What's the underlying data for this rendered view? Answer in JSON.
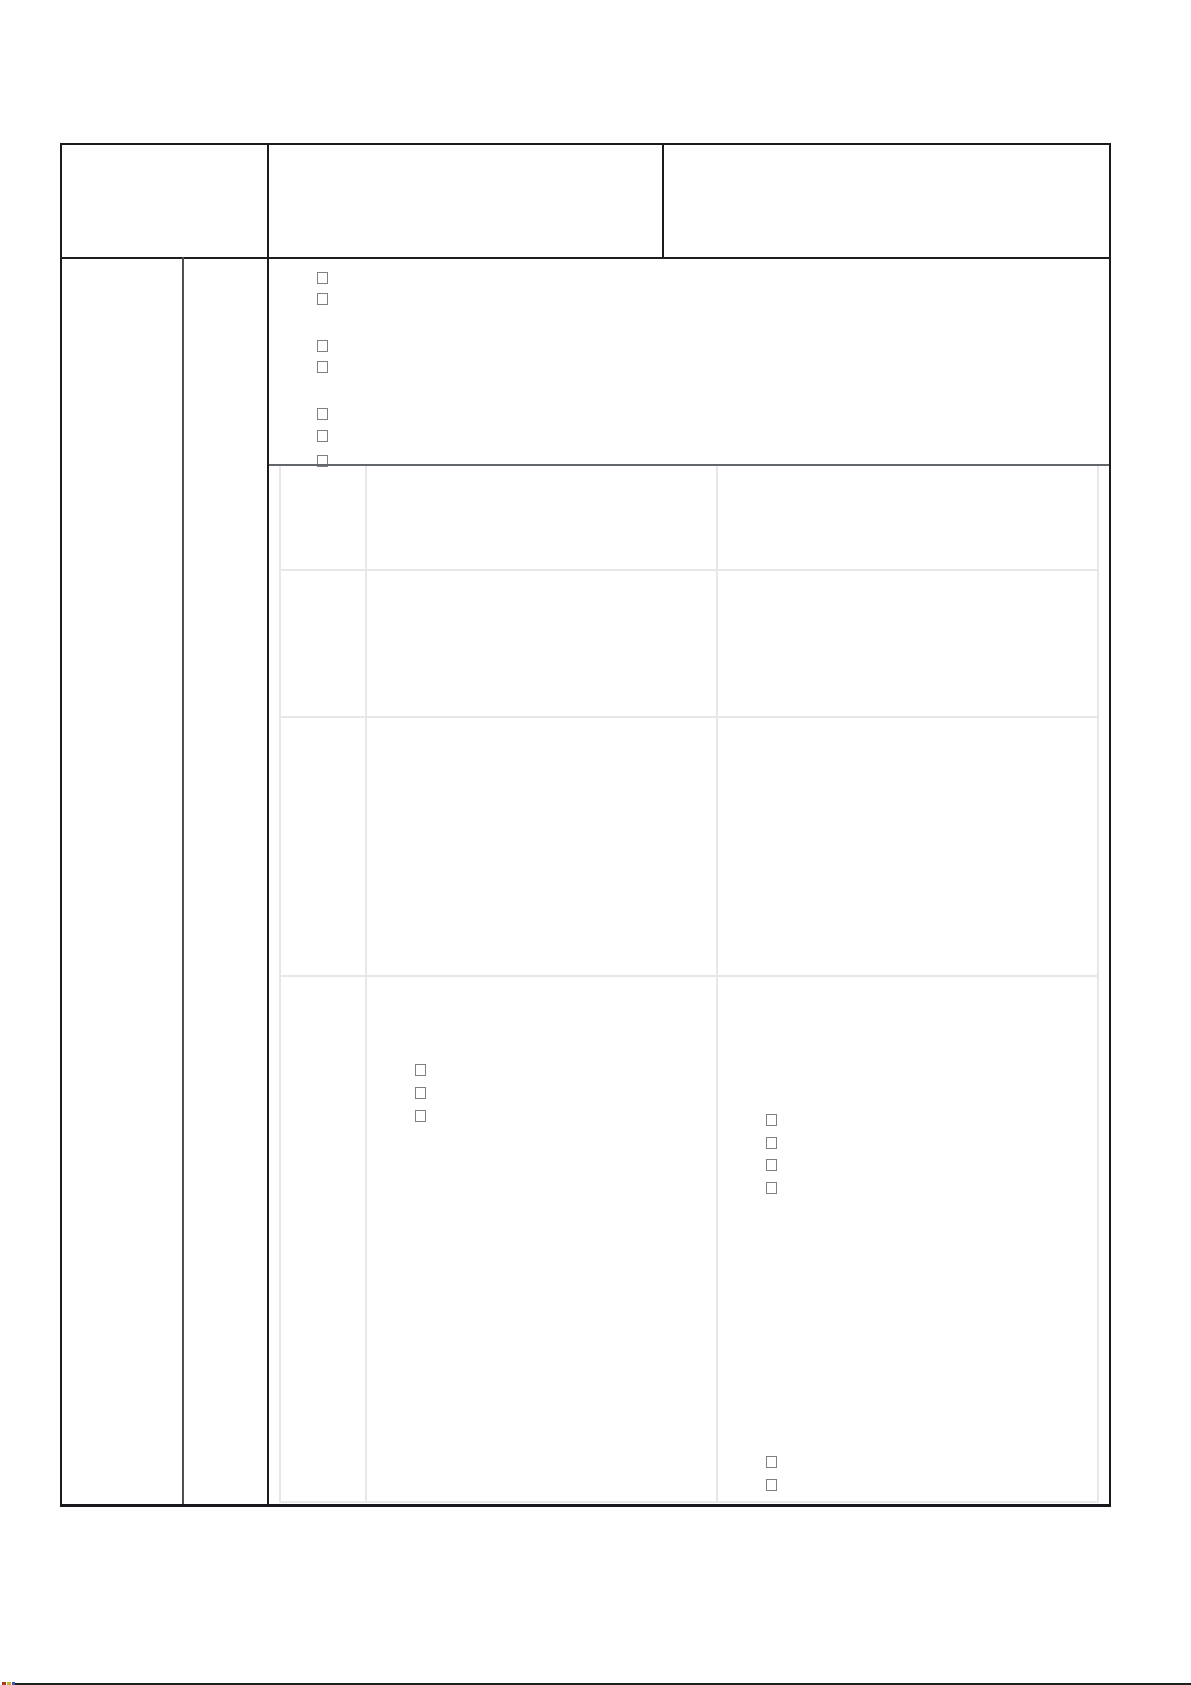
{
  "form": {
    "title_text": "",
    "visible_text": [],
    "checkbox_groups": {
      "top_section_list": {
        "location": "upper cell below header row",
        "items": [
          {
            "checked": false
          },
          {
            "checked": false
          },
          {
            "checked": false
          },
          {
            "checked": false
          },
          {
            "checked": false
          },
          {
            "checked": false
          },
          {
            "checked": false
          }
        ]
      },
      "row4_middle_list": {
        "location": "inner grid row 4, middle column",
        "items": [
          {
            "checked": false
          },
          {
            "checked": false
          },
          {
            "checked": false
          }
        ]
      },
      "row4_right_list": {
        "location": "inner grid row 4, right column",
        "items": [
          {
            "checked": false
          },
          {
            "checked": false
          },
          {
            "checked": false
          },
          {
            "checked": false
          }
        ]
      },
      "row4_right_lower_list": {
        "location": "inner grid row 4, right column bottom",
        "items": [
          {
            "checked": false
          },
          {
            "checked": false
          }
        ]
      }
    }
  },
  "colors": {
    "page_background": "#ffffff",
    "outer_border": "#1b1b1b",
    "secondary_column_divider": "#4f4f52",
    "section_divider": "#63666b",
    "inner_grid_line": "#e7e7e9",
    "checkbox_border": "#7e8084",
    "artifact_line": "#1f1f1f",
    "artifact_dot_red": "#a93a2c",
    "artifact_dot_yellow": "#c6b32b",
    "artifact_dot_blue": "#3f51b5"
  }
}
